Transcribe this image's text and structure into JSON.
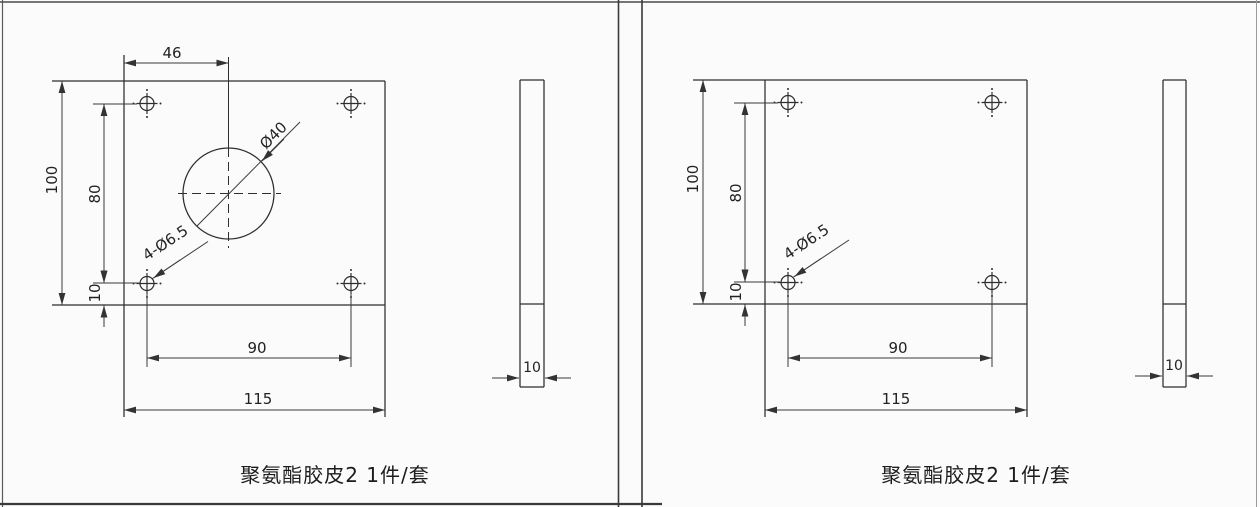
{
  "style": {
    "background": "#fbfbfb",
    "line_color": "#2e2e2e",
    "dim_line_color": "#3a3a3a",
    "text_color": "#222222"
  },
  "panels": [
    {
      "caption": "聚氨酯胶皮2 1件/套",
      "front_view": {
        "width": "115",
        "height": "100",
        "hole_span_h": "90",
        "hole_span_v": "80",
        "hole_bottom_offset": "10",
        "center_offset": "46",
        "center_hole_dia": "Ø40",
        "corner_holes": "4-Ø6.5"
      },
      "side_view": {
        "thickness": "10"
      }
    },
    {
      "caption": "聚氨酯胶皮2 1件/套",
      "front_view": {
        "width": "115",
        "height": "100",
        "hole_span_h": "90",
        "hole_span_v": "80",
        "hole_bottom_offset": "10",
        "corner_holes": "4-Ø6.5"
      },
      "side_view": {
        "thickness": "10"
      }
    }
  ]
}
